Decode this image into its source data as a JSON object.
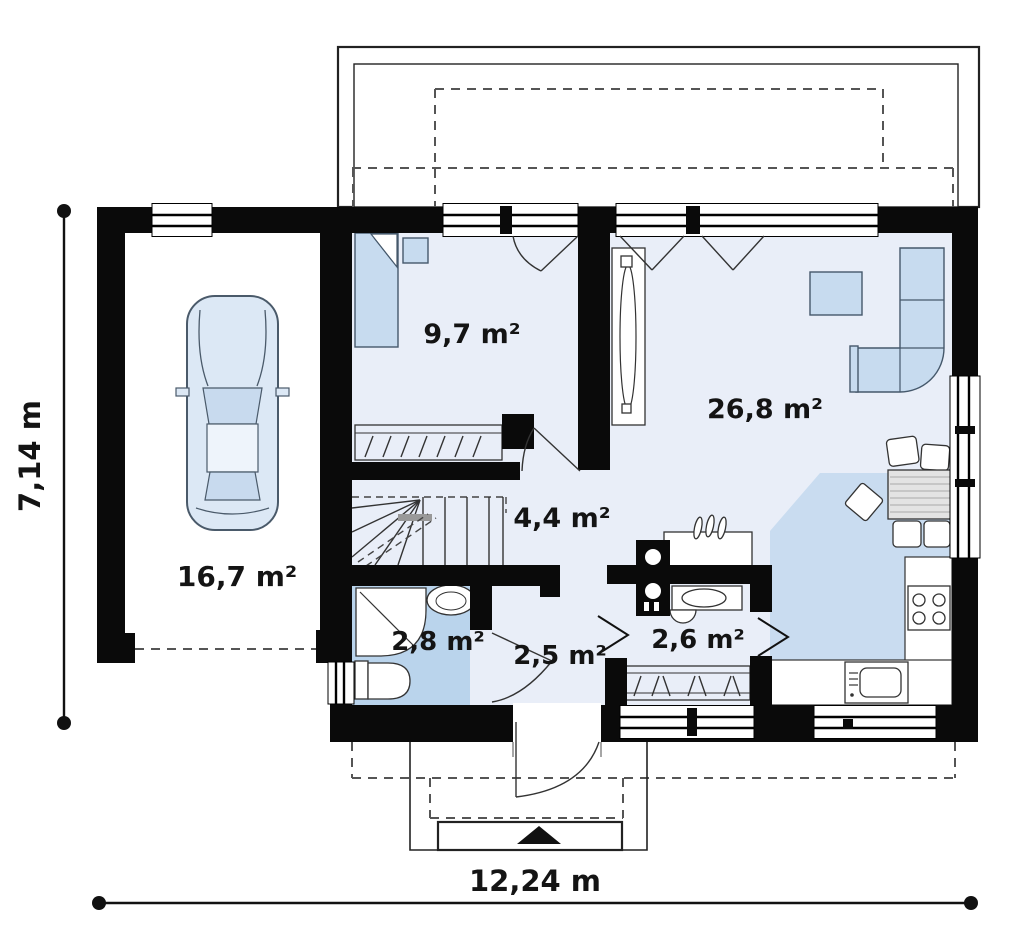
{
  "plan": {
    "width_label": "12,24 m",
    "height_label": "7,14 m"
  },
  "rooms": [
    {
      "name": "garage",
      "area_label": "16,7 m²"
    },
    {
      "name": "bedroom",
      "area_label": "9,7 m²"
    },
    {
      "name": "living-room",
      "area_label": "26,8 m²"
    },
    {
      "name": "hall",
      "area_label": "4,4 m²"
    },
    {
      "name": "bathroom",
      "area_label": "2,8 m²"
    },
    {
      "name": "entry-hall",
      "area_label": "2,5 m²"
    },
    {
      "name": "utility",
      "area_label": "2,6 m²"
    }
  ],
  "colors": {
    "wall": "#0a0a0a",
    "floorLight": "#e9eef8",
    "floorBath": "#bad4ec",
    "floorKitchen": "#c9dcf0",
    "furnitureBlue": "#c7dbef",
    "carBody": "#dce8f5"
  }
}
